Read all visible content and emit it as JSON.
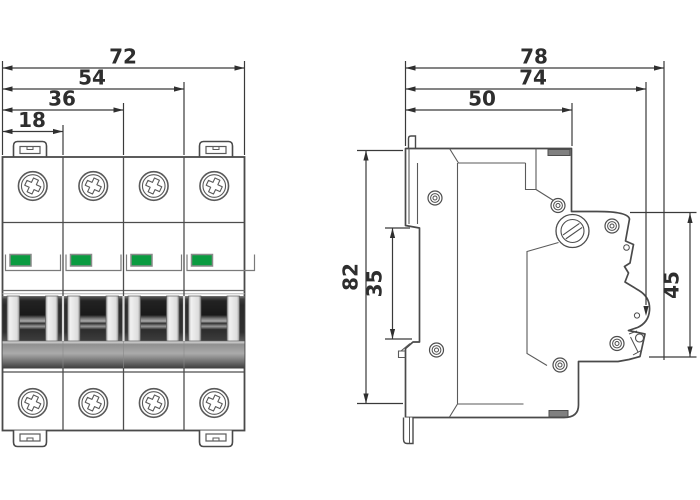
{
  "drawing": {
    "title": "Miniature circuit breaker dimension drawing",
    "front_view": {
      "name": "front view (4-pole breaker)",
      "dim_72": "72",
      "dim_54": "54",
      "dim_36": "36",
      "dim_18": "18"
    },
    "side_view": {
      "name": "side view",
      "dim_78": "78",
      "dim_74": "74",
      "dim_50": "50",
      "dim_82": "82",
      "dim_35": "35",
      "dim_45": "45"
    },
    "colors": {
      "indicator_green": "#0a9b40",
      "line": "#4a4a4a",
      "dim_text": "#2e2e2e"
    }
  }
}
